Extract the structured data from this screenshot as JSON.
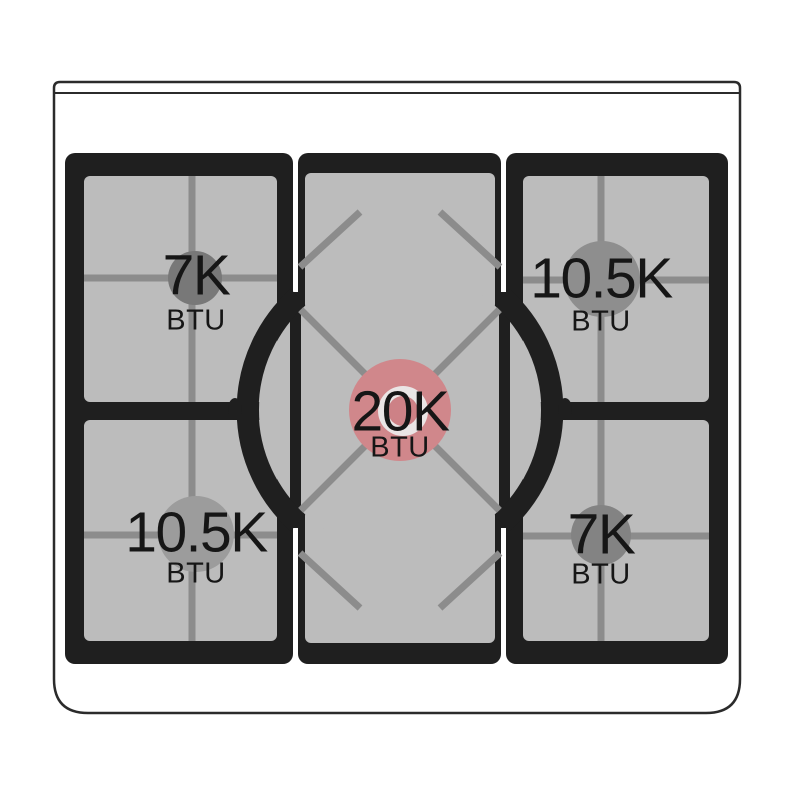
{
  "cooktop": {
    "description_colors": {
      "background": "#ffffff",
      "body_outline": "#2b2b2b",
      "frame_black": "#1f1f1f",
      "surface_gray": "#bcbcbc",
      "grate_gray": "#8c8c8c",
      "cap_ring_white": "#eae5e5",
      "highlight_pink": "#d0878b",
      "label_text": "#161616"
    },
    "burners": [
      {
        "id": "top-left",
        "value": "7K",
        "unit": "BTU",
        "cap_color": "#787878",
        "highlighted": false
      },
      {
        "id": "top-right",
        "value": "10.5K",
        "unit": "BTU",
        "cap_color": "#8e8e8e",
        "highlighted": false
      },
      {
        "id": "center",
        "value": "20K",
        "unit": "BTU",
        "cap_color": "#d0878b",
        "highlighted": true
      },
      {
        "id": "bottom-left",
        "value": "10.5K",
        "unit": "BTU",
        "cap_color": "#9c9c9c",
        "highlighted": false
      },
      {
        "id": "bottom-right",
        "value": "7K",
        "unit": "BTU",
        "cap_color": "#838383",
        "highlighted": false
      }
    ],
    "inner_cap": {
      "ring_color": "#eae5e5",
      "core_color": "#cd8186"
    }
  }
}
